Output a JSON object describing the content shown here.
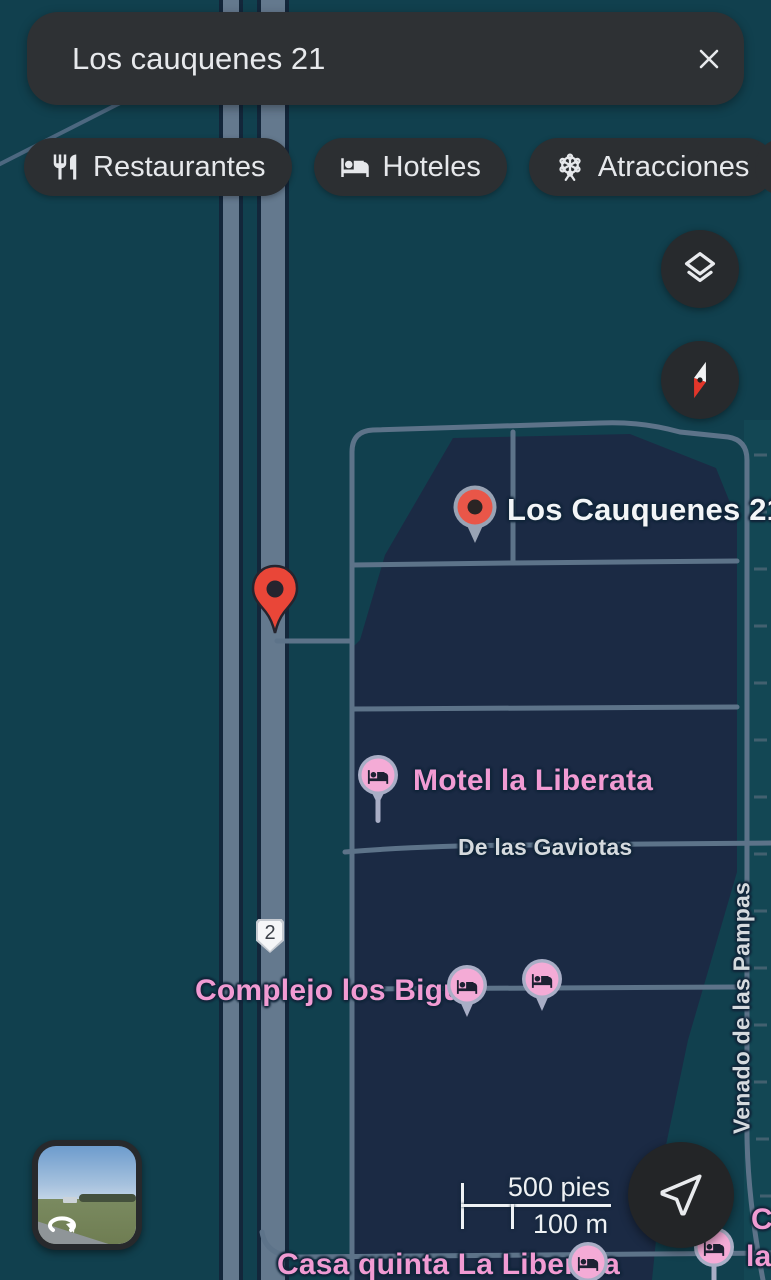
{
  "app_title": "Google Maps (dark mode) search results",
  "colors": {
    "map_background": "#11404e",
    "city_block": "#1b2a44",
    "road": "#5d7389",
    "road_casing": "#13263a",
    "ui_surface": "#2e3134",
    "ui_text": "#e8eaed",
    "pin_red": "#e94638",
    "hotel_pin_pink": "#f4abd6",
    "hotel_label_pink": "#f19bd3",
    "poi_label_white": "#f3f5f7",
    "street_label": "#d5dade"
  },
  "search": {
    "query": "Los cauquenes 21"
  },
  "chips": {
    "restaurants": "Restaurantes",
    "hotels": "Hoteles",
    "attractions": "Atracciones"
  },
  "map": {
    "searched_place_label": "Los Cauquenes 21",
    "hotel_labels": {
      "motel": "Motel la Liberata",
      "complejo": "Complejo los Bigua",
      "casa": "Casa quinta La Liberata"
    },
    "street_labels": {
      "gaviotas": "De las Gaviotas",
      "venado": "Venado de las Pampas"
    },
    "route_shield": "2",
    "clipped_label_line1": "C",
    "clipped_label_line2": "la"
  },
  "scale": {
    "imperial": "500 pies",
    "metric": "100 m"
  }
}
